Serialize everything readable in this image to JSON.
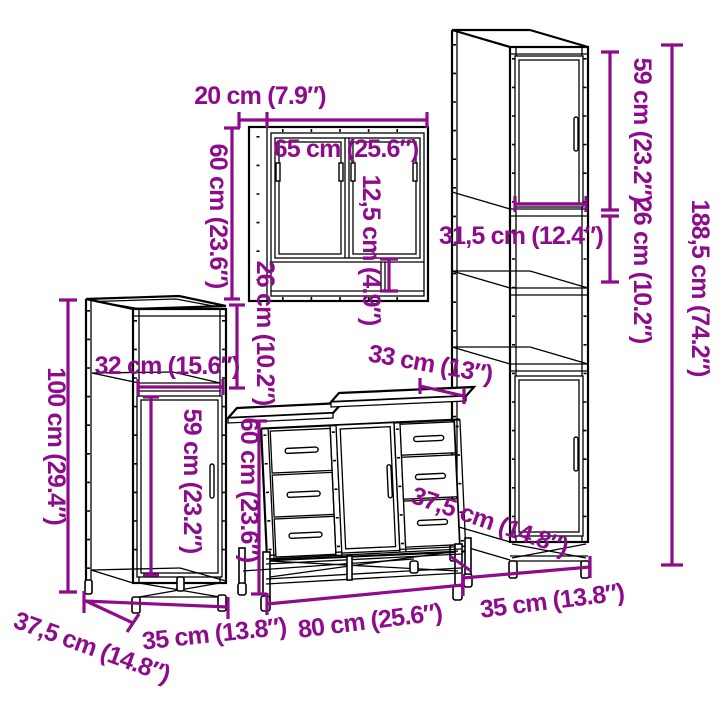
{
  "diagram": {
    "kind": "furniture-dimension-diagram",
    "background": "#ffffff",
    "line_color": "#000000",
    "accent_color": "#8e0c8c",
    "pieces": {
      "mirror_cabinet": {
        "depth": "20 cm (7.9″)",
        "width": "65 cm (25.6″)",
        "height": "60 cm (23.6″)",
        "shelf_height": "12,5 cm (4.9″)",
        "lower_section_height": "26 cm (10.2″)"
      },
      "tall_cabinet": {
        "upper_door_height": "59 cm (23.2″)",
        "shelf_section_height": "26 cm (10.2″)",
        "total_height": "188,5 cm (74.2″)",
        "inner_width": "31,5 cm (12.4″)",
        "base_width": "35 cm (13.8″)"
      },
      "side_cabinet": {
        "height": "100 cm (29.4″)",
        "compartment_width": "32 cm (15.6″)",
        "door_height": "59 cm (23.2″)",
        "depth": "37,5 cm (14.8″)",
        "base_width": "35 cm (13.8″)"
      },
      "sink_cabinet": {
        "top_depth": "33 cm (13″)",
        "height": "60 cm (23.6″)",
        "width": "80 cm (25.6″)",
        "depth": "37,5 cm (14.8″)"
      }
    }
  }
}
